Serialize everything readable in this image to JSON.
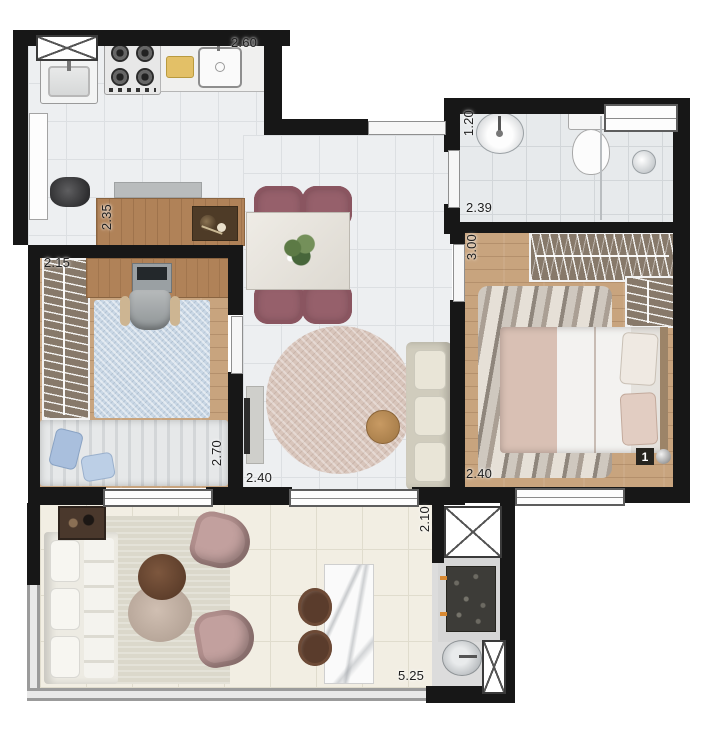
{
  "plan": {
    "unit_marker": "1",
    "dimensions": {
      "kitchen_top": "2.60",
      "kitchen_counter": "2.35",
      "bedroom2_width": "2.15",
      "bedroom2_depth": "2.70",
      "bathroom_width": "1.20",
      "bathroom_length": "2.39",
      "bedroom1_depth": "3.00",
      "bedroom1_width": "2.40",
      "living_width": "2.40",
      "balcony_depth": "2.10",
      "balcony_width": "5.25"
    },
    "colors": {
      "wall": "#171717",
      "tile": "#edeff1",
      "wood_floor": "#c8a47e",
      "closet": "#87796a",
      "dining_chair": "#96606b",
      "sofa": "#d6d2c2",
      "living_rug": "#d8c5bb",
      "bedroom2_rug": "#c9d7e5",
      "balcony_floor": "#f2eee3",
      "armchair": "#c2a09e",
      "stool": "#5a3c2c",
      "marble": "#f9f9f9"
    }
  }
}
